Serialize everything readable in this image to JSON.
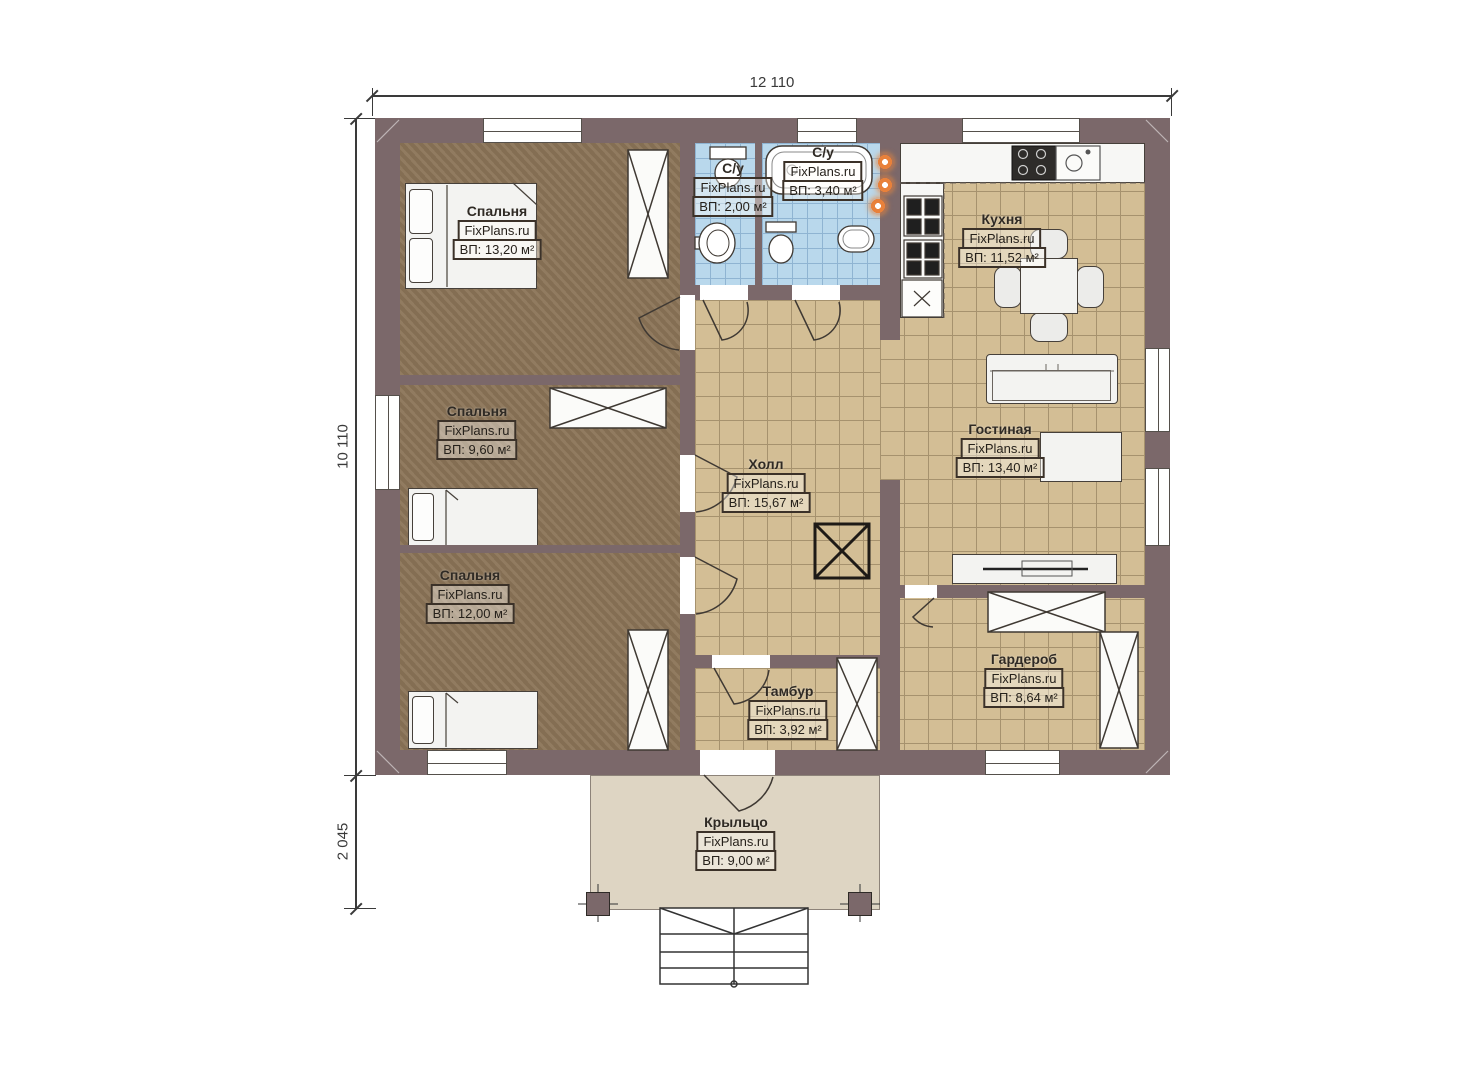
{
  "dimensions": {
    "total_width": "12 110",
    "main_depth": "10 110",
    "porch_depth": "2 045"
  },
  "rooms": {
    "bedroom1": {
      "name": "Спальня",
      "watermark": "FixPlans.ru",
      "area": "ВП: 13,20 м²"
    },
    "bedroom2": {
      "name": "Спальня",
      "watermark": "FixPlans.ru",
      "area": "ВП: 9,60 м²"
    },
    "bedroom3": {
      "name": "Спальня",
      "watermark": "FixPlans.ru",
      "area": "ВП: 12,00 м²"
    },
    "bathroom1": {
      "name": "С/у",
      "watermark": "FixPlans.ru",
      "area": "ВП: 2,00 м²"
    },
    "bathroom2": {
      "name": "С/у",
      "watermark": "FixPlans.ru",
      "area": "ВП: 3,40 м²"
    },
    "kitchen": {
      "name": "Кухня",
      "watermark": "FixPlans.ru",
      "area": "ВП: 11,52 м²"
    },
    "hall": {
      "name": "Холл",
      "watermark": "FixPlans.ru",
      "area": "ВП: 15,67 м²"
    },
    "living": {
      "name": "Гостиная",
      "watermark": "FixPlans.ru",
      "area": "ВП: 13,40 м²"
    },
    "tambour": {
      "name": "Тамбур",
      "watermark": "FixPlans.ru",
      "area": "ВП: 3,92 м²"
    },
    "wardrobe": {
      "name": "Гардероб",
      "watermark": "FixPlans.ru",
      "area": "ВП: 8,64 м²"
    },
    "porch": {
      "name": "Крыльцо",
      "watermark": "FixPlans.ru",
      "area": "ВП: 9,00 м²"
    }
  },
  "symbols": {
    "wardrobe-icon": "rectangle with X cross",
    "door-icon": "quarter-arc swing",
    "chimney-icon": "bold square with X",
    "stairs-icon": "stepped rectangle with direction lines",
    "heating-riser-icon": "orange glowing circle"
  },
  "colors": {
    "wall": "#7b686a",
    "bedroom_floor": "#8b7457",
    "tile_floor": "#d3be95",
    "tile_grid": "#a6926e",
    "bath_floor": "#b9d8ec",
    "bath_grid": "#8fb4d2",
    "porch_floor": "#ded5c3",
    "furniture_fill": "#f3f3f1",
    "accent_orange": "#e8813b"
  }
}
